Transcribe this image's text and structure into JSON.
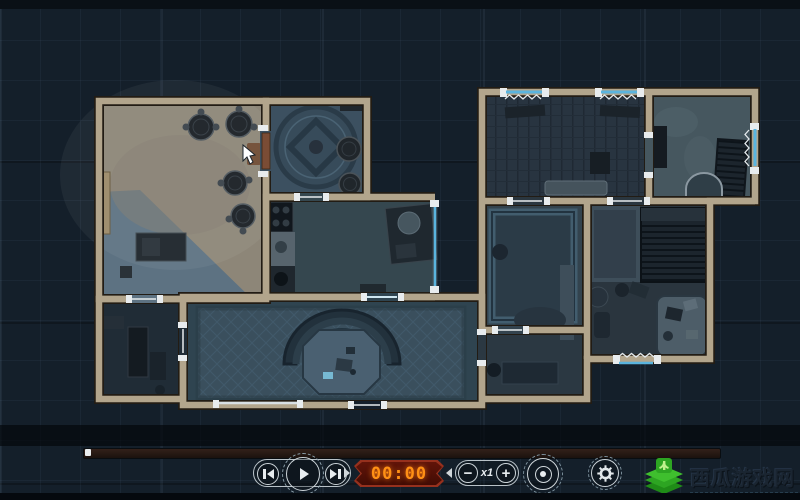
{
  "app": {
    "type": "tactical-map-replay-viewer"
  },
  "map": {
    "label": "floorplan-top-down-view",
    "cursor": "white-pointer-on-objective-room"
  },
  "timeline": {
    "progress_percent": 0
  },
  "controls": {
    "skip_start_icon": "skip-to-start",
    "play_icon": "play",
    "skip_end_icon": "skip-to-end",
    "timer_value": "00:00",
    "decrease_glyph": "−",
    "speed_label": "x1",
    "increase_glyph": "+",
    "eye_icon": "view-toggle",
    "gear_icon": "settings"
  },
  "watermark": {
    "title": "西瓜游戏网"
  },
  "colors": {
    "background": "#141f2a",
    "wall": "#b2a58c",
    "window_accent": "#5ab4de",
    "timer_bg": "#4d0f07",
    "timer_text": "#ff9015",
    "logo_green": "#3fbf2e"
  }
}
